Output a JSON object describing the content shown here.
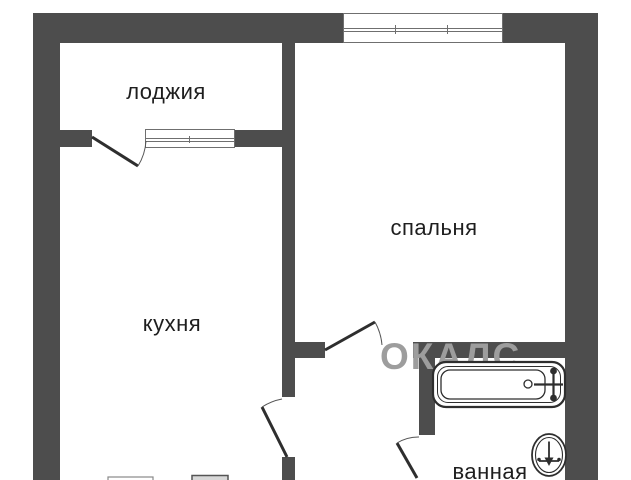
{
  "plan": {
    "type": "floor-plan",
    "labels": {
      "loggia": "лоджия",
      "bedroom": "спальня",
      "kitchen": "кухня",
      "corridor": "коридор",
      "bathroom": "ванная"
    },
    "watermark": "ОКАЛС",
    "colors": {
      "wall": "#4d4d4d",
      "label": "#1e1e1e",
      "watermark": "#9d9d9d",
      "line": "#2e2e2e",
      "background": "#ffffff"
    },
    "fixtures": [
      "bathtub",
      "bath-faucet",
      "drain",
      "washbasin",
      "stove",
      "kitchen-counter"
    ],
    "windows": [
      "loggia-window",
      "bedroom-window"
    ],
    "doors": [
      "loggia-door",
      "kitchen-door",
      "bedroom-door",
      "bathroom-door"
    ]
  }
}
